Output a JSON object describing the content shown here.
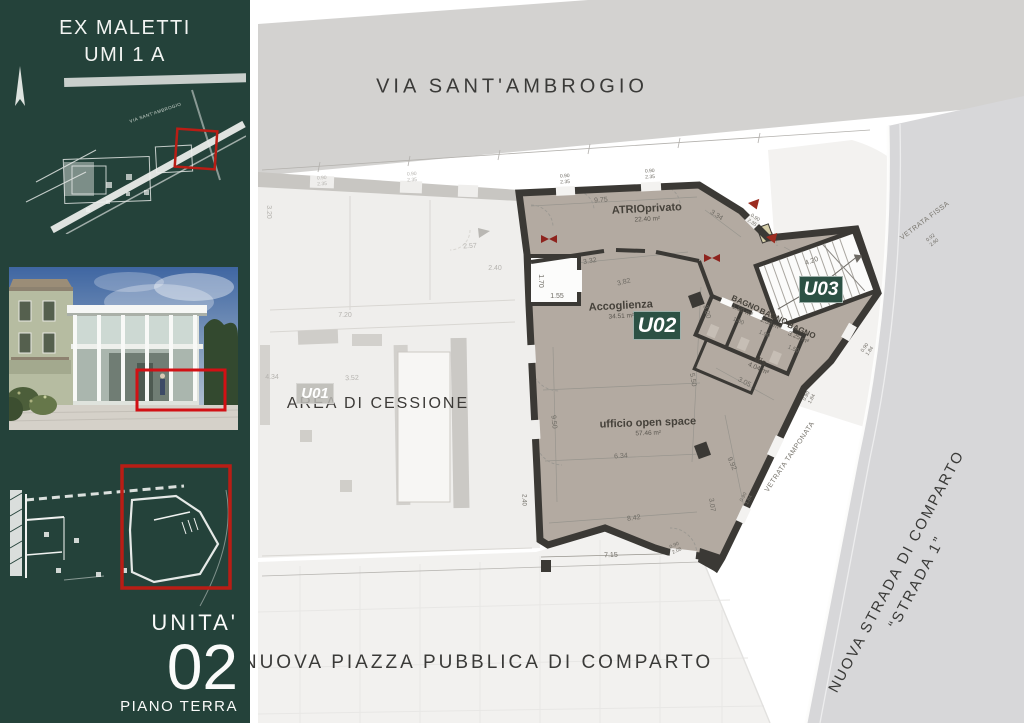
{
  "colors": {
    "sidebar_green": "#24423a",
    "badge_green": "#2c5144",
    "floor_taupe": "#b3aaa1",
    "wall_dark": "#3b3935",
    "street_gray": "#d3d2d0",
    "road_gray": "#d7d7d9",
    "highlight_red": "#c00000",
    "door_red": "#8e231d"
  },
  "sidebar": {
    "title_line1": "EX MALETTI",
    "title_line2": "UMI 1 A",
    "map_label": "VIA SANT'AMBROGIO",
    "unit_label": "UNITA'",
    "unit_number": "02",
    "unit_floor": "PIANO TERRA"
  },
  "main": {
    "street_top": "VIA SANT'AMBROGIO",
    "plaza_bottom": "NUOVA PIAZZA PUBBLICA DI COMPARTO",
    "road_right_line1": "NUOVA STRADA DI COMPARTO",
    "road_right_line2": "“STRADA 1”",
    "area_label": "AREA DI CESSIONE",
    "badges": [
      {
        "id": "u01",
        "label": "U01",
        "x": 296,
        "y": 383,
        "w": 38,
        "h": 21,
        "style": "faded"
      },
      {
        "id": "u02",
        "label": "U02",
        "x": 633,
        "y": 311,
        "w": 48,
        "h": 29,
        "style": "solid"
      },
      {
        "id": "u03",
        "label": "U03",
        "x": 799,
        "y": 276,
        "w": 44,
        "h": 27,
        "style": "solid"
      }
    ],
    "rooms": [
      {
        "name": "ATRIOprivato",
        "area": "22.40 m²",
        "x": 647,
        "y": 213,
        "r": -3,
        "s": 11
      },
      {
        "name": "Accoglienza",
        "area": "34.51 m²",
        "x": 621,
        "y": 310,
        "r": -3,
        "s": 11
      },
      {
        "name": "ufficio open space",
        "area": "57.46 m²",
        "x": 648,
        "y": 427,
        "r": -2,
        "s": 11
      },
      {
        "name": "BAGNO",
        "area": "1.50 m²",
        "x": 744,
        "y": 307,
        "r": 24,
        "s": 8
      },
      {
        "name": "BAGNO",
        "area": "1.50 m²",
        "x": 772,
        "y": 320,
        "r": 24,
        "s": 8
      },
      {
        "name": "BAGNO",
        "area": "3.25 m²",
        "x": 800,
        "y": 334,
        "r": 24,
        "s": 8
      },
      {
        "name": "dis.",
        "area": "4.04 m²",
        "x": 760,
        "y": 365,
        "r": 24,
        "s": 8
      }
    ],
    "annotations": [
      {
        "text": "VETRATA FISSA",
        "x": 925,
        "y": 221,
        "r": -37
      },
      {
        "text": "VETRATA TAMPONATA",
        "x": 790,
        "y": 457,
        "r": -56
      }
    ],
    "dims": [
      {
        "t": "9.75",
        "x": 601,
        "y": 201,
        "r": -4
      },
      {
        "t": "0.90\n2.35",
        "x": 565,
        "y": 180,
        "r": -3,
        "s": 5
      },
      {
        "t": "0.90\n2.35",
        "x": 650,
        "y": 175,
        "r": -3,
        "s": 5
      },
      {
        "t": "0.90\n2.35",
        "x": 753,
        "y": 221,
        "r": 33,
        "s": 5
      },
      {
        "t": "3.34",
        "x": 716,
        "y": 216,
        "r": 33
      },
      {
        "t": "4.20",
        "x": 812,
        "y": 262,
        "r": -20
      },
      {
        "t": "3.32",
        "x": 590,
        "y": 262,
        "r": -10
      },
      {
        "t": "3.82",
        "x": 624,
        "y": 283,
        "r": -14
      },
      {
        "t": "1.55",
        "x": 557,
        "y": 297,
        "r": 0
      },
      {
        "t": "1.70",
        "x": 540,
        "y": 281,
        "r": 90
      },
      {
        "t": "3.00",
        "x": 706,
        "y": 312,
        "r": 75
      },
      {
        "t": "1.00",
        "x": 738,
        "y": 322,
        "r": 24,
        "s": 6
      },
      {
        "t": "1.00",
        "x": 764,
        "y": 335,
        "r": 24,
        "s": 6
      },
      {
        "t": "1.50",
        "x": 793,
        "y": 350,
        "r": 24,
        "s": 6
      },
      {
        "t": "5.50",
        "x": 692,
        "y": 380,
        "r": 80
      },
      {
        "t": "3.05",
        "x": 744,
        "y": 383,
        "r": 28
      },
      {
        "t": "9.50",
        "x": 553,
        "y": 422,
        "r": 84
      },
      {
        "t": "6.34",
        "x": 621,
        "y": 457,
        "r": -4
      },
      {
        "t": "9.92",
        "x": 731,
        "y": 464,
        "r": 66
      },
      {
        "t": "3.07",
        "x": 711,
        "y": 505,
        "r": 82
      },
      {
        "t": "8.42",
        "x": 634,
        "y": 519,
        "r": -8
      },
      {
        "t": "7.15",
        "x": 611,
        "y": 556,
        "r": -2
      },
      {
        "t": "0.90\n2.08",
        "x": 676,
        "y": 549,
        "r": -25,
        "s": 5
      },
      {
        "t": "0.90\n1.84",
        "x": 868,
        "y": 350,
        "r": -55,
        "s": 5
      },
      {
        "t": "0.90\n1.84",
        "x": 810,
        "y": 398,
        "r": -62,
        "s": 5
      },
      {
        "t": "0.90\n1.84",
        "x": 747,
        "y": 499,
        "r": -62,
        "s": 5
      },
      {
        "t": "0.92\n2.60",
        "x": 933,
        "y": 241,
        "r": -37,
        "s": 5
      },
      {
        "t": "2.40",
        "x": 523,
        "y": 500,
        "r": 90,
        "s": 6
      },
      {
        "t": "2.40",
        "x": 495,
        "y": 269,
        "r": 0,
        "cls": "faded"
      },
      {
        "t": "7.20",
        "x": 345,
        "y": 316,
        "r": 0,
        "cls": "faded"
      },
      {
        "t": "2.57",
        "x": 470,
        "y": 247,
        "r": -3,
        "cls": "faded"
      },
      {
        "t": "3.52",
        "x": 352,
        "y": 379,
        "r": -2,
        "cls": "faded"
      },
      {
        "t": "4.34",
        "x": 272,
        "y": 378,
        "r": 0,
        "cls": "faded"
      },
      {
        "t": "3.20",
        "x": 268,
        "y": 212,
        "r": 90,
        "cls": "faded"
      },
      {
        "t": "0.90\n2.35",
        "x": 322,
        "y": 182,
        "r": -3,
        "s": 5,
        "cls": "faded"
      },
      {
        "t": "0.90\n2.35",
        "x": 412,
        "y": 178,
        "r": -3,
        "s": 5,
        "cls": "faded"
      }
    ]
  }
}
